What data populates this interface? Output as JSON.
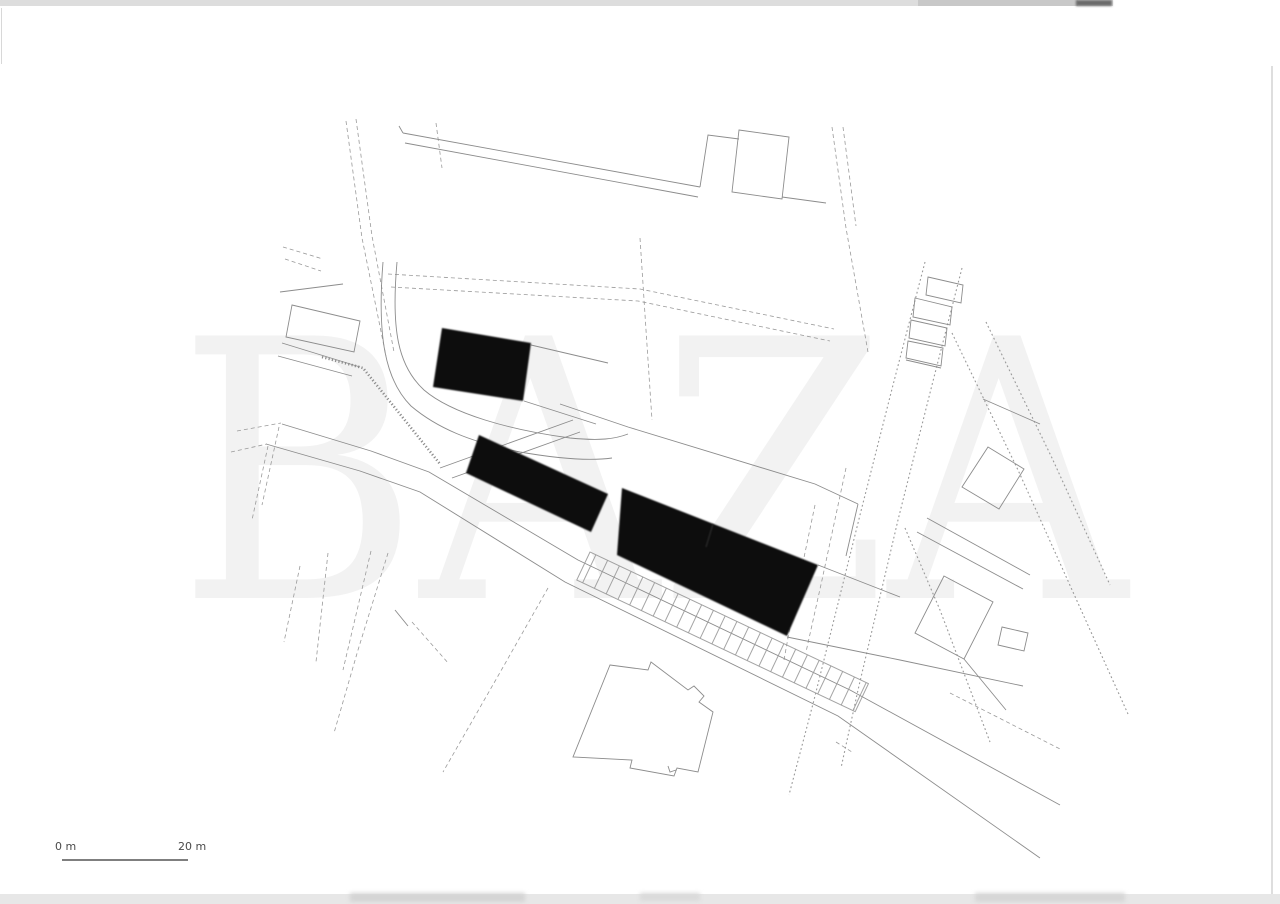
{
  "watermark": {
    "text": "BAZA",
    "color": "rgba(0,0,0,0.05)"
  },
  "scale_bar": {
    "start_label": "0 m",
    "end_label": "20 m",
    "text_color": "#4a4a4a",
    "line_color": "#555555"
  },
  "colors": {
    "background": "#ffffff",
    "building_fill": "#0d0d0d",
    "solid_line": "#8c8c8c",
    "dashed_line": "#9a9a9a",
    "dotted_street": "#999999",
    "edge_strip_top": "#dddddd",
    "edge_strip_bottom": "#e7e7e7",
    "edge_blob": "#6a6a6a",
    "edge_line_right": "#c9c9c9"
  }
}
